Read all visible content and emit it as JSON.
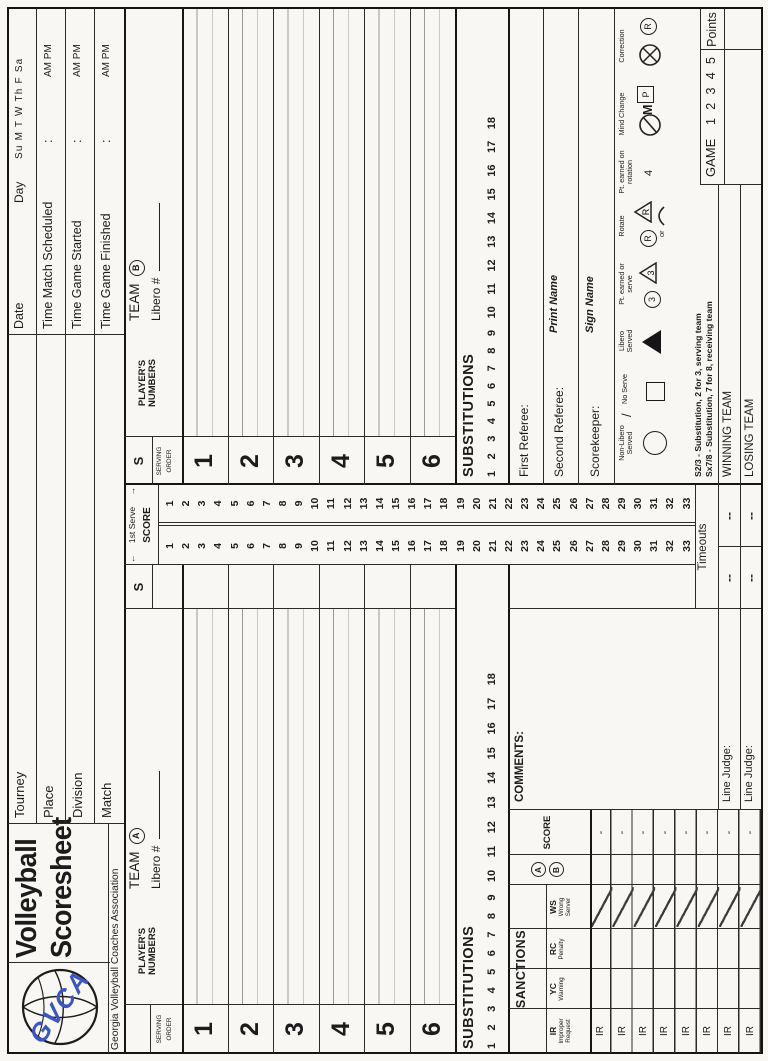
{
  "logo": {
    "letters": "GVCA"
  },
  "title": {
    "line1": "Volleyball",
    "line2": "Scoresheet",
    "association": "Georgia Volleyball Coaches Association"
  },
  "fields": {
    "tourney": "Tourney",
    "place": "Place",
    "division": "Division",
    "match": "Match"
  },
  "schedule": {
    "date": "Date",
    "day": "Day",
    "days": "Su M T W Th F Sa",
    "match_scheduled": "Time Match Scheduled",
    "game_started": "Time Game Started",
    "game_finished": "Time Game Finished",
    "colon": ":",
    "ampm": "AM PM"
  },
  "team_a": {
    "team": "TEAM",
    "badge": "A",
    "libero": "Libero #",
    "players_header": "PLAYER'S NUMBERS",
    "serving": "SERVING",
    "order": "ORDER",
    "s": "S",
    "rows": [
      "1",
      "2",
      "3",
      "4",
      "5",
      "6"
    ],
    "subs_label": "SUBSTITUTIONS",
    "subs": [
      "1",
      "2",
      "3",
      "4",
      "5",
      "6",
      "7",
      "8",
      "9",
      "10",
      "11",
      "12",
      "13",
      "14",
      "15",
      "16",
      "17",
      "18"
    ]
  },
  "team_b": {
    "team": "TEAM",
    "badge": "B",
    "libero": "Libero #",
    "players_header": "PLAYER'S NUMBERS",
    "serving": "SERVING",
    "order": "ORDER",
    "s": "S",
    "rows": [
      "1",
      "2",
      "3",
      "4",
      "5",
      "6"
    ],
    "subs_label": "SUBSTITUTIONS",
    "subs": [
      "1",
      "2",
      "3",
      "4",
      "5",
      "6",
      "7",
      "8",
      "9",
      "10",
      "11",
      "12",
      "13",
      "14",
      "15",
      "16",
      "17",
      "18"
    ]
  },
  "score_strip": {
    "arrow_left": "←",
    "arrow_right": "→",
    "first_serve": "1st Serve",
    "score": "SCORE",
    "numbers": [
      "1",
      "2",
      "3",
      "4",
      "5",
      "6",
      "7",
      "8",
      "9",
      "10",
      "11",
      "12",
      "13",
      "14",
      "15",
      "16",
      "17",
      "18",
      "19",
      "20",
      "21",
      "22",
      "23",
      "24",
      "25",
      "26",
      "27",
      "28",
      "29",
      "30",
      "31",
      "32",
      "33"
    ]
  },
  "sanctions": {
    "title": "SANCTIONS",
    "col1_abbr": "IR",
    "col1_sub": "Improper Request",
    "col2_abbr": "YC",
    "col2_sub": "Warning",
    "col3_abbr": "RC",
    "col3_sub": "Penalty",
    "col4_abbr": "WS",
    "col4_sub": "Wrong Server",
    "badge_a": "A",
    "badge_b": "B",
    "score_header": "SCORE",
    "row_labels": [
      "IR",
      "IR",
      "IR",
      "IR",
      "IR",
      "IR",
      "IR",
      "IR"
    ],
    "row_scores": [
      "-",
      "-",
      "-",
      "-",
      "-",
      "-",
      "-",
      "-"
    ]
  },
  "comments": {
    "label": "COMMENTS:"
  },
  "officials": {
    "first_referee": "First Referee:",
    "second_referee": "Second Referee:",
    "scorekeeper": "Scorekeeper:",
    "print_name": "Print Name",
    "sign_name": "Sign Name"
  },
  "legend": {
    "non_libero": "Non-Libero Served",
    "slash": "/",
    "no_serve": "No Serve",
    "libero_served": "Libero Served",
    "pt_earned_serve": "Pt. earned or serve",
    "rotate": "Rotate",
    "or": "or",
    "pt_earned_rotation": "Pt. earned on rotation",
    "pt_rotation_value": "4",
    "mind_change": "Mind Change",
    "correction": "Correction",
    "sym_three": "3",
    "sym_r": "R",
    "sym_m": "M",
    "sym_p": "P"
  },
  "notes": {
    "s23": "S2/3 - Substitution, 2 for 3, serving team",
    "sx78": "Sx7/8 - Substitution, 7 for 8, receiving team"
  },
  "footer": {
    "timeouts": "Timeouts",
    "dash": "--",
    "winning": "WINNING TEAM",
    "losing": "LOSING TEAM",
    "line_judge": "Line Judge:",
    "game": "GAME",
    "game_numbers": [
      "1",
      "2",
      "3",
      "4",
      "5"
    ],
    "points": "Points"
  }
}
